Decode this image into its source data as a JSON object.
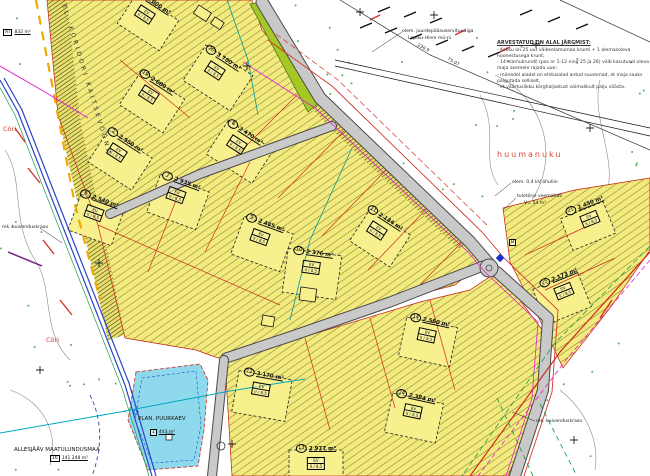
{
  "title": "Detailplaneeringu põhijoonis",
  "notes": {
    "title": "ARVESTATUD ON ALAL JÄRGMIST:",
    "lines": [
      "- Kokku on 25 uut väikeelamumaa krunti + 1 olemasoleva hoonestusega krunt;",
      "- 14 elamukrundil (pos nr 1-12 ning 25 ja 26) võib kasutusel oleva maja asemele rajada uue;",
      "- mõnedel aladel on ehitusalad antud suuremad, et maja saaks paigutada selliselt,",
      "- et väärtuslikku kõrghaljastust võimalikult palju säästa."
    ]
  },
  "labels": [
    {
      "text": "EL. KORIDORI KAITSEVÖÖND",
      "x": 66,
      "y": 4,
      "size": 6,
      "color": "#333",
      "rot": 73,
      "spacing": 3
    },
    {
      "text": "Cöri",
      "x": 3,
      "y": 126,
      "size": 6.5,
      "color": "#cc3a28",
      "rot": 0,
      "spacing": 0
    },
    {
      "text": "Cöri",
      "x": 46,
      "y": 337,
      "size": 6.5,
      "color": "#cc3a28",
      "rot": 0,
      "spacing": 0
    },
    {
      "text": "huumanuku",
      "x": 497,
      "y": 151,
      "size": 8,
      "color": "#d9442e",
      "rot": 0,
      "spacing": 2
    },
    {
      "text": "olem. 0,4 kV õhuliin",
      "x": 512,
      "y": 180,
      "size": 4.6,
      "color": "#222",
      "rot": 0,
      "spacing": 0
    },
    {
      "text": "tuletõrje veemahuti",
      "x": 517,
      "y": 194,
      "size": 4.6,
      "color": "#222",
      "rot": 0,
      "spacing": 0
    },
    {
      "text": "V= 54 m³",
      "x": 524,
      "y": 201,
      "size": 4.6,
      "color": "#222",
      "rot": 0,
      "spacing": 0
    },
    {
      "text": "olem. juurdepääsuservituudiga",
      "x": 402,
      "y": 29,
      "size": 4.6,
      "color": "#222",
      "rot": 0,
      "spacing": 0
    },
    {
      "text": "Lepiku-Hinni mü-ni",
      "x": 408,
      "y": 36,
      "size": 4.6,
      "color": "#222",
      "rot": 0,
      "spacing": 0
    },
    {
      "text": "mk. kuivenduskraav",
      "x": 536,
      "y": 419,
      "size": 4.6,
      "color": "#222",
      "rot": 0,
      "spacing": 0
    },
    {
      "text": "mk. kuivenduskraav",
      "x": 2,
      "y": 225,
      "size": 4.6,
      "color": "#222",
      "rot": 0,
      "spacing": 0
    },
    {
      "text": "ALLESJÄÄV MAATULUNDUSMAA",
      "x": 14,
      "y": 447,
      "size": 5.5,
      "color": "#111",
      "rot": 0,
      "spacing": 0
    },
    {
      "text": "PLAN. PUURKAEV",
      "x": 138,
      "y": 416,
      "size": 5.5,
      "color": "#111",
      "rot": 0,
      "spacing": 0
    },
    {
      "text": "75,07",
      "x": 448,
      "y": 58,
      "size": 4.5,
      "color": "#222",
      "rot": 28,
      "spacing": 0
    },
    {
      "text": "230,9",
      "x": 418,
      "y": 44,
      "size": 4.5,
      "color": "#222",
      "rot": 28,
      "spacing": 0
    }
  ],
  "boxed_labels": [
    {
      "n": "16",
      "t": "141 248 m²",
      "x": 50,
      "y": 455
    },
    {
      "n": "1",
      "t": "443 m²",
      "x": 150,
      "y": 429
    },
    {
      "n": "AT",
      "t": "832 m²",
      "x": 3,
      "y": 29
    },
    {
      "n": "B",
      "t": "",
      "x": 509,
      "y": 239
    }
  ],
  "parcels": [
    {
      "n": "1",
      "area": "3 000 m²",
      "t1": "EV",
      "t2": "II / 8,5",
      "x": 148,
      "y": 10,
      "rot": 33,
      "w": 50,
      "h": 36
    },
    {
      "n": "20",
      "area": "3 700 m²",
      "t1": "EV",
      "t2": "II / 8,5",
      "x": 218,
      "y": 66,
      "rot": 33,
      "w": 56,
      "h": 42
    },
    {
      "n": "19",
      "area": "2 680 m²",
      "t1": "EV",
      "t2": "II / 8,5",
      "x": 152,
      "y": 90,
      "rot": 33,
      "w": 52,
      "h": 40
    },
    {
      "n": "2",
      "area": "2 950 m²",
      "t1": "EV",
      "t2": "II / 8,5",
      "x": 120,
      "y": 148,
      "rot": 33,
      "w": 52,
      "h": 38
    },
    {
      "n": "8",
      "area": "2 470 m²",
      "t1": "EV",
      "t2": "II / 8,5",
      "x": 240,
      "y": 140,
      "rot": 33,
      "w": 54,
      "h": 40
    },
    {
      "n": "7",
      "area": "2 935 m²",
      "t1": "EV",
      "t2": "II / 8,5",
      "x": 178,
      "y": 190,
      "rot": 20,
      "w": 52,
      "h": 40
    },
    {
      "n": "6",
      "area": "2 540 m²",
      "t1": "EV",
      "t2": "II / 8,5",
      "x": 96,
      "y": 208,
      "rot": 20,
      "w": 46,
      "h": 38
    },
    {
      "n": "9",
      "area": "2 485 m²",
      "t1": "EV",
      "t2": "II / 8,5",
      "x": 262,
      "y": 232,
      "rot": 20,
      "w": 52,
      "h": 40
    },
    {
      "n": "10",
      "area": "2 376 m²",
      "t1": "EV",
      "t2": "II / 8,5",
      "x": 312,
      "y": 262,
      "rot": 8,
      "w": 54,
      "h": 44
    },
    {
      "n": "11",
      "area": "2 134 m²",
      "t1": "EV",
      "t2": "II / 8,5",
      "x": 380,
      "y": 226,
      "rot": 33,
      "w": 48,
      "h": 38
    },
    {
      "n": "12",
      "area": "3 170 m²",
      "t1": "EV",
      "t2": "II / 8,5",
      "x": 262,
      "y": 384,
      "rot": 10,
      "w": 54,
      "h": 42
    },
    {
      "n": "13",
      "area": "2 977 m²",
      "t1": "EV",
      "t2": "II / 8,5",
      "x": 316,
      "y": 458,
      "rot": 0,
      "w": 54,
      "h": 40
    },
    {
      "n": "14",
      "area": "2 560 m²",
      "t1": "EV",
      "t2": "II / 8,5",
      "x": 428,
      "y": 330,
      "rot": 12,
      "w": 52,
      "h": 40
    },
    {
      "n": "24",
      "area": "2 384 m²",
      "t1": "EV",
      "t2": "II / 8,5",
      "x": 414,
      "y": 406,
      "rot": 12,
      "w": 52,
      "h": 40
    },
    {
      "n": "25",
      "area": "2 173 m²",
      "t1": "EV",
      "t2": "II / 8,5",
      "x": 562,
      "y": 286,
      "rot": -22,
      "w": 48,
      "h": 38
    },
    {
      "n": "21",
      "area": "2 450 m²",
      "t1": "EV",
      "t2": "II / 8,5",
      "x": 588,
      "y": 214,
      "rot": -22,
      "w": 46,
      "h": 34
    }
  ],
  "colors": {
    "parcel_fill": "#f3ea7e",
    "envelope_fill": "#f7f08c",
    "hatch_line": "#45450f",
    "road_fill": "#c9c9c9",
    "road_edge": "#4a4a4a",
    "green_strip": "#a6c827",
    "pond_fill": "#8ed9ec",
    "boundary_red": "#cc2b1d",
    "utility_magenta": "#e21fd0",
    "utility_blue": "#2b43c8",
    "utility_cyan": "#00a7c0",
    "utility_green": "#1f9e45",
    "utility_orange": "#f2a900",
    "contour_gray": "#8a8a8a",
    "vegetation_dot": "#2e9e3a",
    "place_name_red": "#d9442e"
  }
}
